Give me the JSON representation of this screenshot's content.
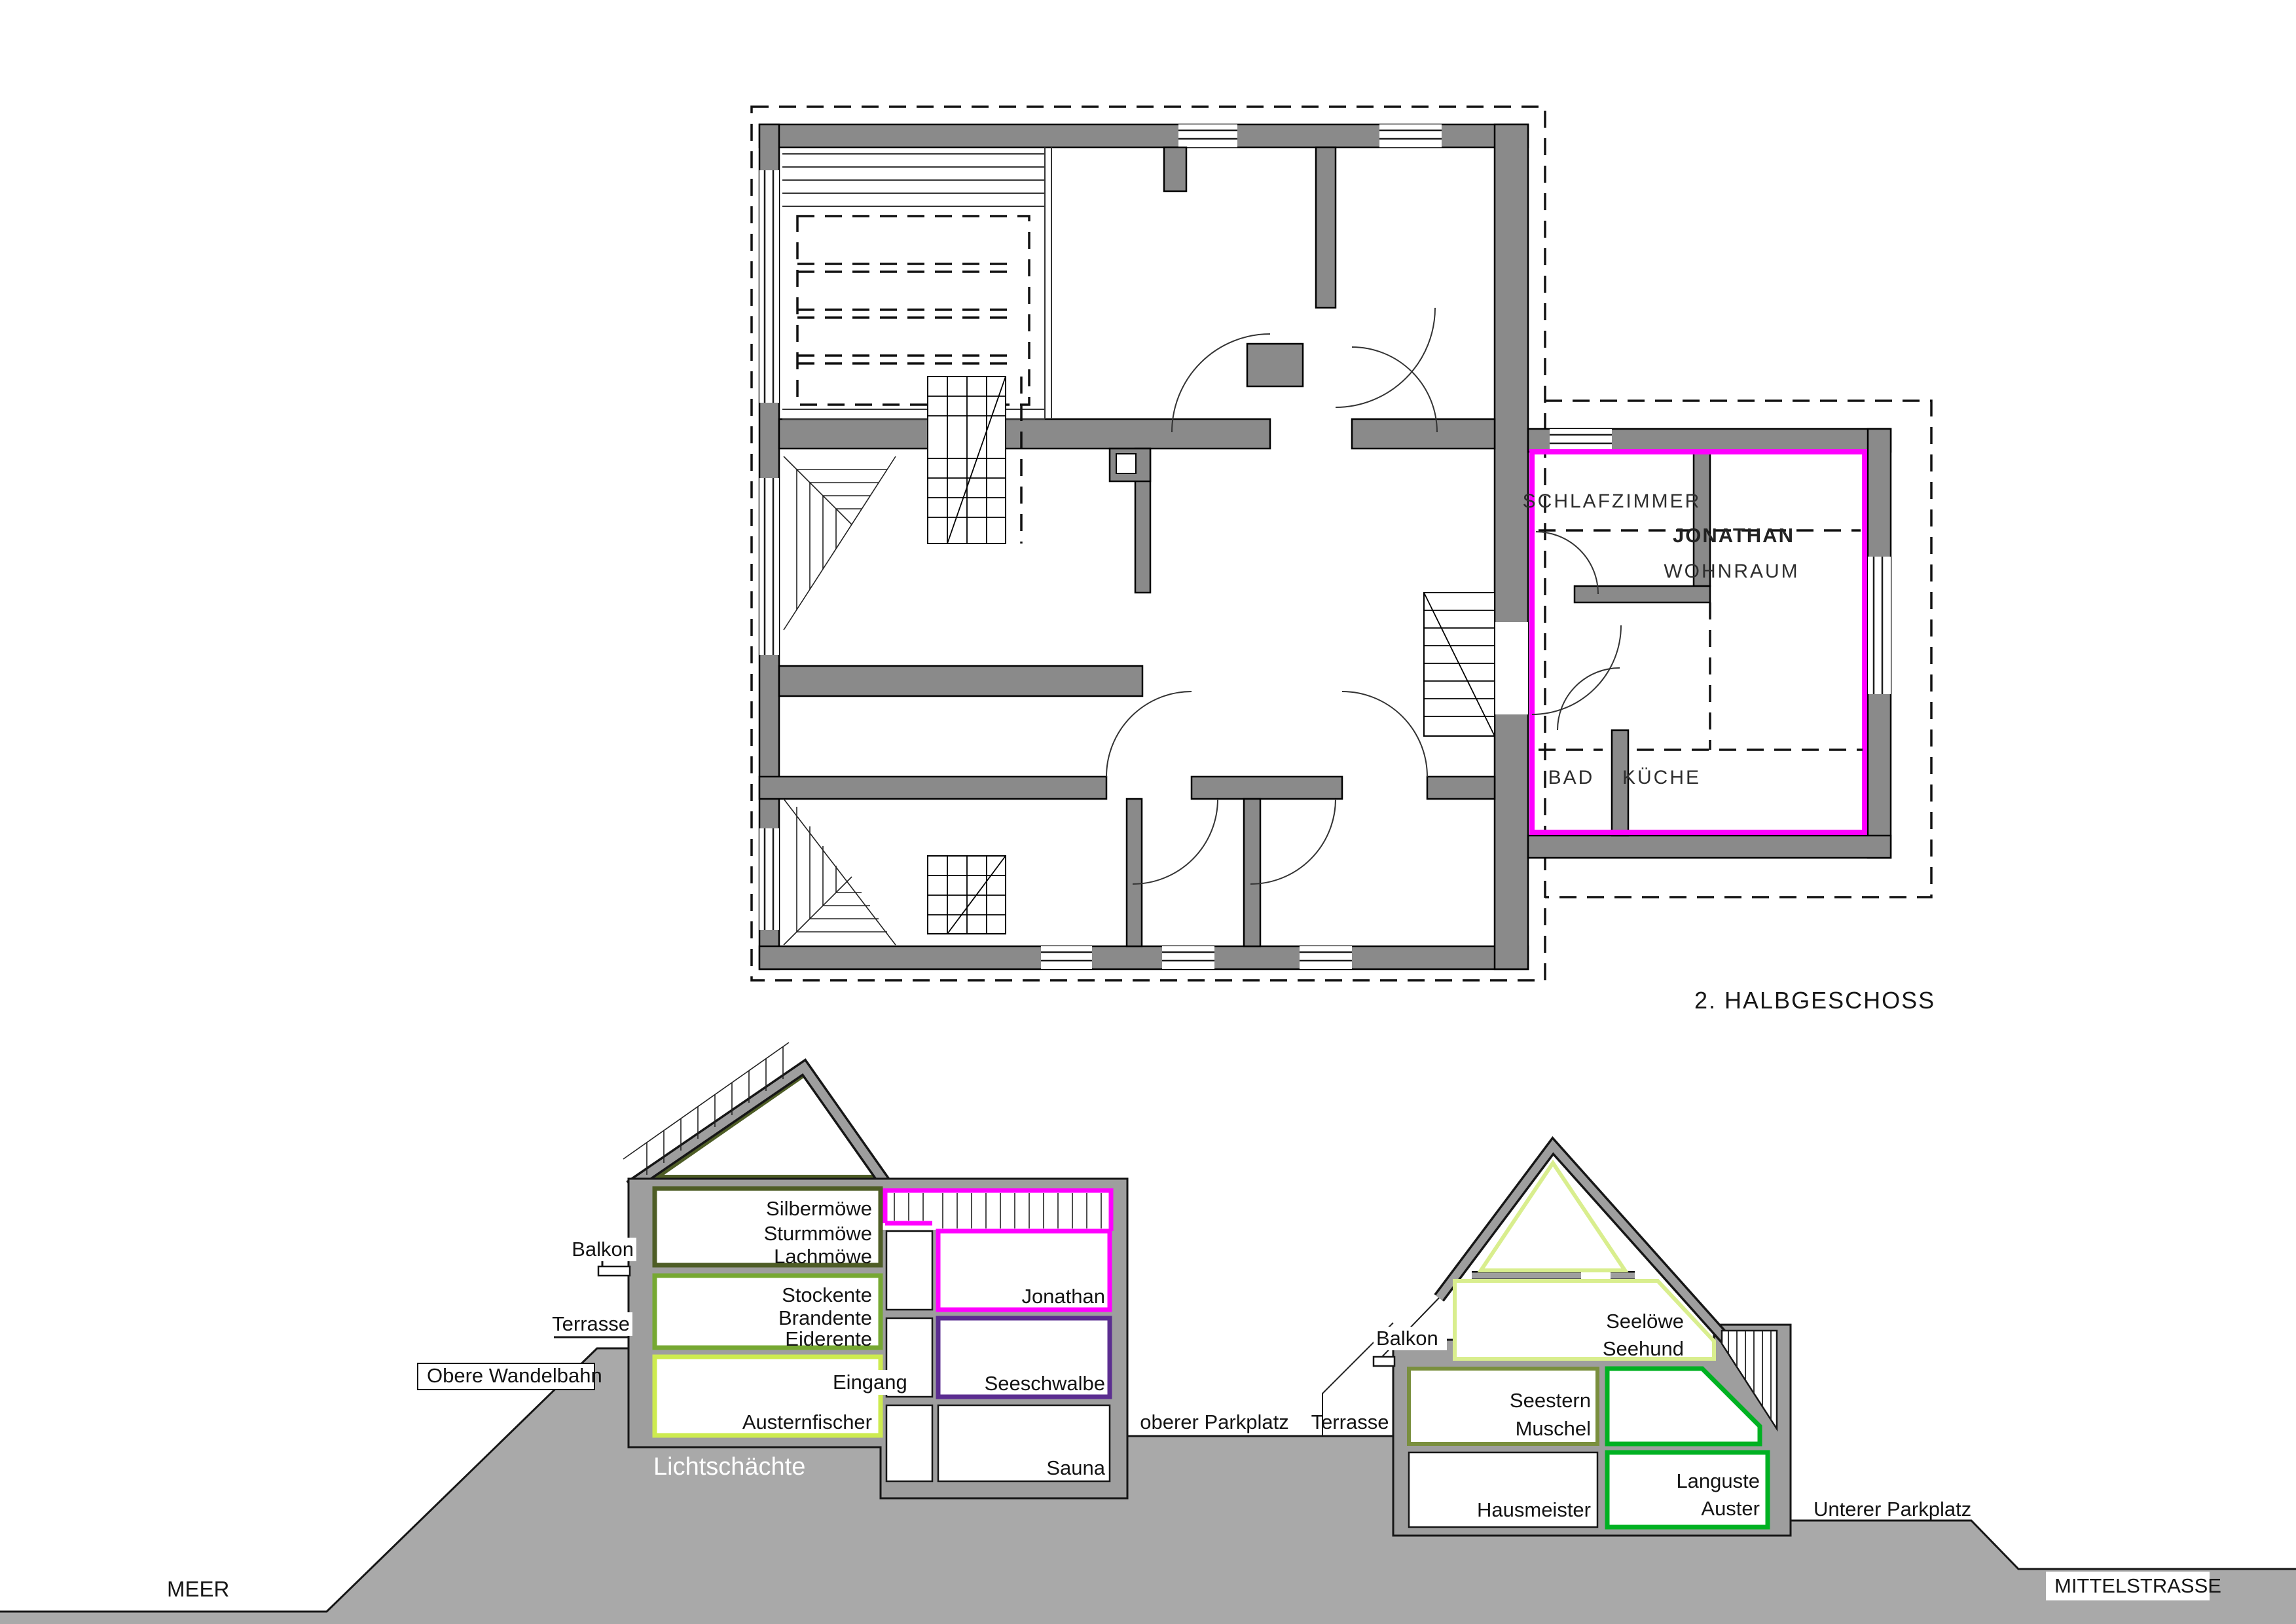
{
  "title": {
    "floor_label": "2. HALBGESCHOSS"
  },
  "plan": {
    "rooms": {
      "schlafzimmer": "SCHLAFZIMMER",
      "jonathan": "JONATHAN",
      "wohnraum": "WOHNRAUM",
      "bad": "BAD",
      "kueche": "KÜCHE"
    }
  },
  "sections": {
    "left_building": {
      "rooms": [
        {
          "id": "silbermoewe",
          "lines": [
            "Silbermöwe",
            "Sturmmöwe",
            "Lachmöwe"
          ]
        },
        {
          "id": "stockente",
          "lines": [
            "Stockente",
            "Brandente",
            "Eiderente"
          ]
        },
        {
          "id": "austernfischer",
          "lines": [
            "Austernfischer"
          ]
        },
        {
          "id": "jonathan",
          "lines": [
            "Jonathan"
          ]
        },
        {
          "id": "seeschwalbe",
          "lines": [
            "Seeschwalbe"
          ]
        },
        {
          "id": "sauna",
          "lines": [
            "Sauna"
          ]
        }
      ],
      "labels": {
        "balkon": "Balkon",
        "terrasse": "Terrasse",
        "eingang": "Eingang",
        "obere_wandelbahn": "Obere Wandelbahn",
        "lichtschaechte": "Lichtschächte"
      }
    },
    "right_building": {
      "rooms": [
        {
          "id": "seeloewe",
          "lines": [
            "Seelöwe",
            "Seehund"
          ]
        },
        {
          "id": "seestern",
          "lines": [
            "Seestern",
            "Muschel"
          ]
        },
        {
          "id": "hausmeister",
          "lines": [
            "Hausmeister"
          ]
        },
        {
          "id": "languste",
          "lines": [
            "Languste",
            "Auster"
          ]
        }
      ],
      "labels": {
        "balkon": "Balkon",
        "terrasse": "Terrasse",
        "oberer_parkplatz": "oberer Parkplatz",
        "unterer_parkplatz": "Unterer Parkplatz"
      }
    },
    "ground": {
      "meer": "MEER",
      "mittelstrasse": "MITTELSTRASSE"
    }
  },
  "colors": {
    "magenta": "#ff00ff",
    "dark_olive": "#4e5d26",
    "green": "#76a832",
    "yellow_green": "#cdeb4f",
    "light_green": "#d9ee8e",
    "olive": "#7a8f3e",
    "bright_green": "#00b122",
    "purple": "#5b2d90",
    "plan_wall": "#8a8a8a",
    "section_wall": "#9e9e9e",
    "terrain": "#a9a9a9"
  }
}
